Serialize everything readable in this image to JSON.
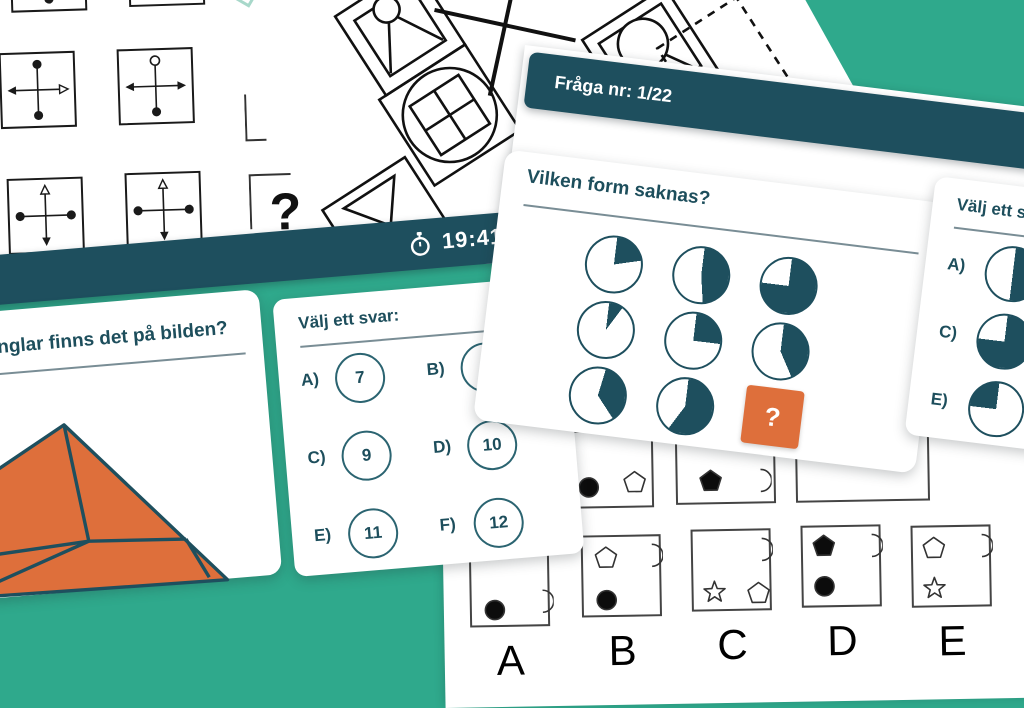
{
  "colors": {
    "background": "#2FA98C",
    "band": "#1E4F5E",
    "heading": "#1D4E5C",
    "orange": "#DE6F3B",
    "circle_stroke": "#2B6471",
    "line": "#1a1a1a"
  },
  "top_sheet": {
    "question_mark": "?"
  },
  "pattern_sheet": {
    "cells": [
      "envelope",
      "x-cross",
      "circle-v",
      "grid-circle",
      "dashed",
      "fan"
    ]
  },
  "matrix_sheet": {
    "cells": [
      {
        "top": "dot",
        "right": "dot",
        "bottom": "dot",
        "left": "dot"
      },
      {
        "top": "dot",
        "right": "dot",
        "bottom": "dot",
        "left": "dot"
      },
      {
        "top": "dot",
        "right": "arrowOpen",
        "bottom": "dot",
        "left": "arrow"
      },
      {
        "top": "ring",
        "right": "arrow",
        "bottom": "dot",
        "left": "arrow"
      },
      {
        "top": "triOpen",
        "right": "dot",
        "bottom": "arrow",
        "left": "dot"
      },
      {
        "top": "triOpen",
        "right": "dot",
        "bottom": "arrow",
        "left": "dot"
      }
    ]
  },
  "timer_bar": {
    "time": "19:41"
  },
  "left_quiz": {
    "question_fragment": "nglar finns det på bilden?",
    "answer_panel": {
      "title": "Välj ett svar:",
      "options": [
        {
          "label": "A)",
          "value": "7"
        },
        {
          "label": "B)",
          "value": "8"
        },
        {
          "label": "C)",
          "value": "9"
        },
        {
          "label": "D)",
          "value": "10"
        },
        {
          "label": "E)",
          "value": "11"
        },
        {
          "label": "F)",
          "value": "12"
        }
      ]
    }
  },
  "fraga_page": {
    "header": "Fråga nr: 1/22",
    "question": "Vilken form saknas?",
    "missing_tile_label": "?",
    "pies": [
      {
        "start": 0,
        "sweep": 75
      },
      {
        "start": 0,
        "sweep": 170
      },
      {
        "start": 0,
        "sweep": 270
      },
      {
        "start": 0,
        "sweep": 30
      },
      {
        "start": 0,
        "sweep": 90
      },
      {
        "start": 0,
        "sweep": 150
      },
      {
        "start": 10,
        "sweep": 130
      },
      {
        "start": 0,
        "sweep": 210
      }
    ],
    "answer_panel": {
      "title": "Välj ett svar:",
      "options": [
        {
          "label": "A)",
          "pie": {
            "start": 0,
            "sweep": 180
          }
        },
        {
          "label": "C)",
          "pie": {
            "start": 0,
            "sweep": 270
          }
        },
        {
          "label": "E)",
          "pie": {
            "start": 270,
            "sweep": 90
          }
        }
      ]
    }
  },
  "bottom_sheet": {
    "matrix_row": [
      {
        "shapes": [
          {
            "type": "circle",
            "filled": true,
            "x": 14,
            "y": 42
          },
          {
            "type": "pentagon",
            "filled": false,
            "x": 60,
            "y": 38
          }
        ]
      },
      {
        "shapes": [
          {
            "type": "pentagon",
            "filled": true,
            "x": 20,
            "y": 40
          },
          {
            "type": "crescent",
            "filled": false,
            "x": 68,
            "y": 40
          }
        ]
      },
      {
        "shapes": []
      }
    ],
    "options": [
      {
        "letter": "A",
        "shapes": [
          {
            "type": "circle",
            "filled": true,
            "x": 10,
            "y": 50
          },
          {
            "type": "crescent",
            "filled": false,
            "x": 56,
            "y": 42
          }
        ]
      },
      {
        "letter": "B",
        "shapes": [
          {
            "type": "pentagon",
            "filled": false,
            "x": 10,
            "y": 8
          },
          {
            "type": "crescent",
            "filled": false,
            "x": 54,
            "y": 6
          },
          {
            "type": "circle",
            "filled": true,
            "x": 10,
            "y": 50
          }
        ]
      },
      {
        "letter": "C",
        "shapes": [
          {
            "type": "crescent",
            "filled": false,
            "x": 54,
            "y": 6
          },
          {
            "type": "star",
            "filled": false,
            "x": 8,
            "y": 48
          },
          {
            "type": "pentagon",
            "filled": false,
            "x": 52,
            "y": 50
          }
        ]
      },
      {
        "letter": "D",
        "shapes": [
          {
            "type": "pentagon",
            "filled": true,
            "x": 8,
            "y": 6
          },
          {
            "type": "crescent",
            "filled": false,
            "x": 54,
            "y": 6
          },
          {
            "type": "circle",
            "filled": true,
            "x": 8,
            "y": 46
          }
        ]
      },
      {
        "letter": "E",
        "shapes": [
          {
            "type": "pentagon",
            "filled": false,
            "x": 8,
            "y": 8
          },
          {
            "type": "crescent",
            "filled": false,
            "x": 54,
            "y": 6
          },
          {
            "type": "star",
            "filled": false,
            "x": 8,
            "y": 48
          }
        ]
      }
    ]
  }
}
